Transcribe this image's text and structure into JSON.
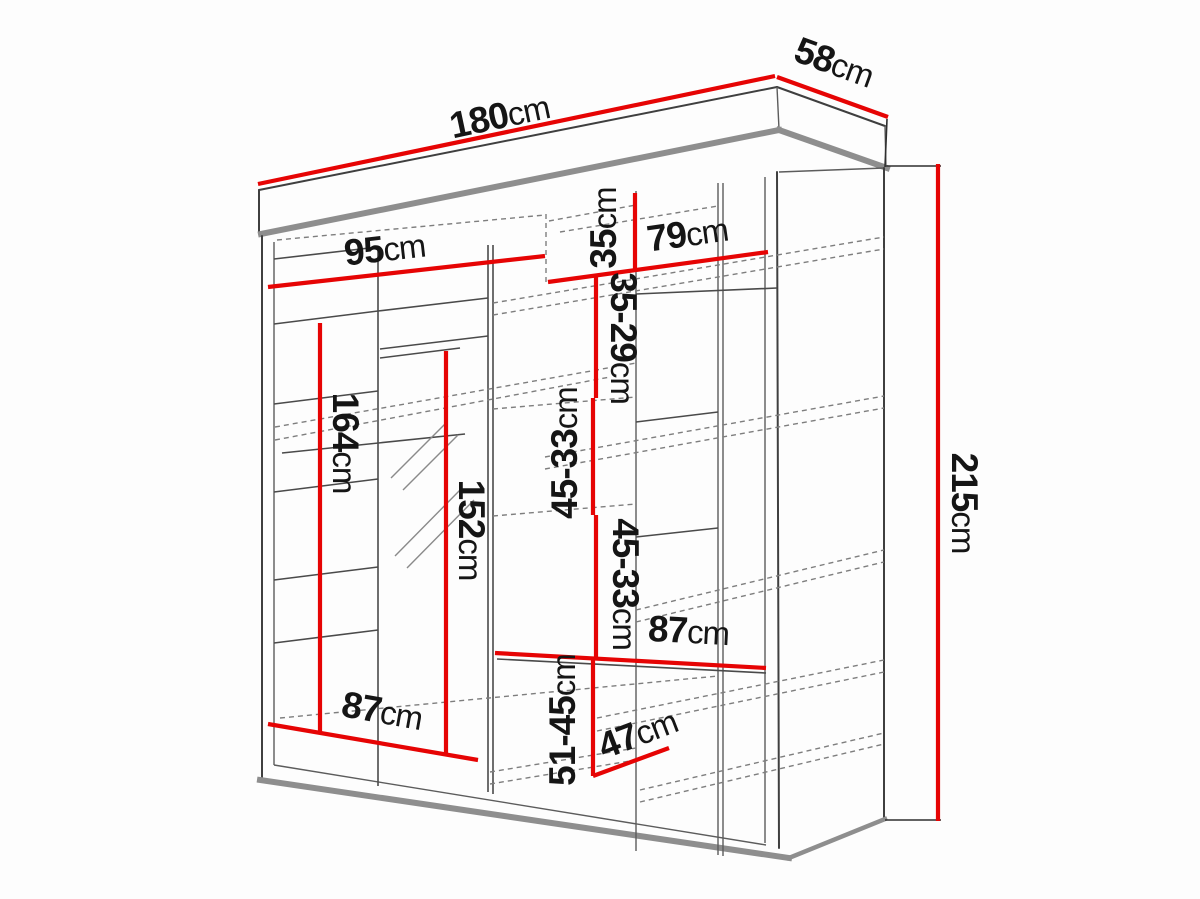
{
  "diagram": {
    "type": "wardrobe-technical-drawing",
    "unit": "cm",
    "colors": {
      "dimension_line": "#e60404",
      "label_text": "#151515",
      "structure_dark": "#3f3f3f",
      "structure_light": "#8e8e8e",
      "background": "#fdfdfd"
    },
    "dimensions": {
      "overall_width": {
        "num": "180",
        "unit": "cm"
      },
      "overall_depth": {
        "num": "58",
        "unit": "cm"
      },
      "overall_height": {
        "num": "215",
        "unit": "cm"
      },
      "left_section_width": {
        "num": "95",
        "unit": "cm"
      },
      "right_section_width": {
        "num": "79",
        "unit": "cm"
      },
      "top_compartment_height": {
        "num": "35",
        "unit": "cm"
      },
      "shelf_gap_upper": {
        "num": "35-29",
        "unit": "cm"
      },
      "shelf_gap_mid_1": {
        "num": "45-33",
        "unit": "cm"
      },
      "shelf_gap_mid_2": {
        "num": "45-33",
        "unit": "cm"
      },
      "hanging_height_left": {
        "num": "164",
        "unit": "cm"
      },
      "mirror_door_height": {
        "num": "152",
        "unit": "cm"
      },
      "shelf_width_right": {
        "num": "87",
        "unit": "cm"
      },
      "shelf_gap_lower": {
        "num": "51-45",
        "unit": "cm"
      },
      "compartment_width": {
        "num": "47",
        "unit": "cm"
      },
      "shelf_width_left": {
        "num": "87",
        "unit": "cm"
      }
    }
  }
}
